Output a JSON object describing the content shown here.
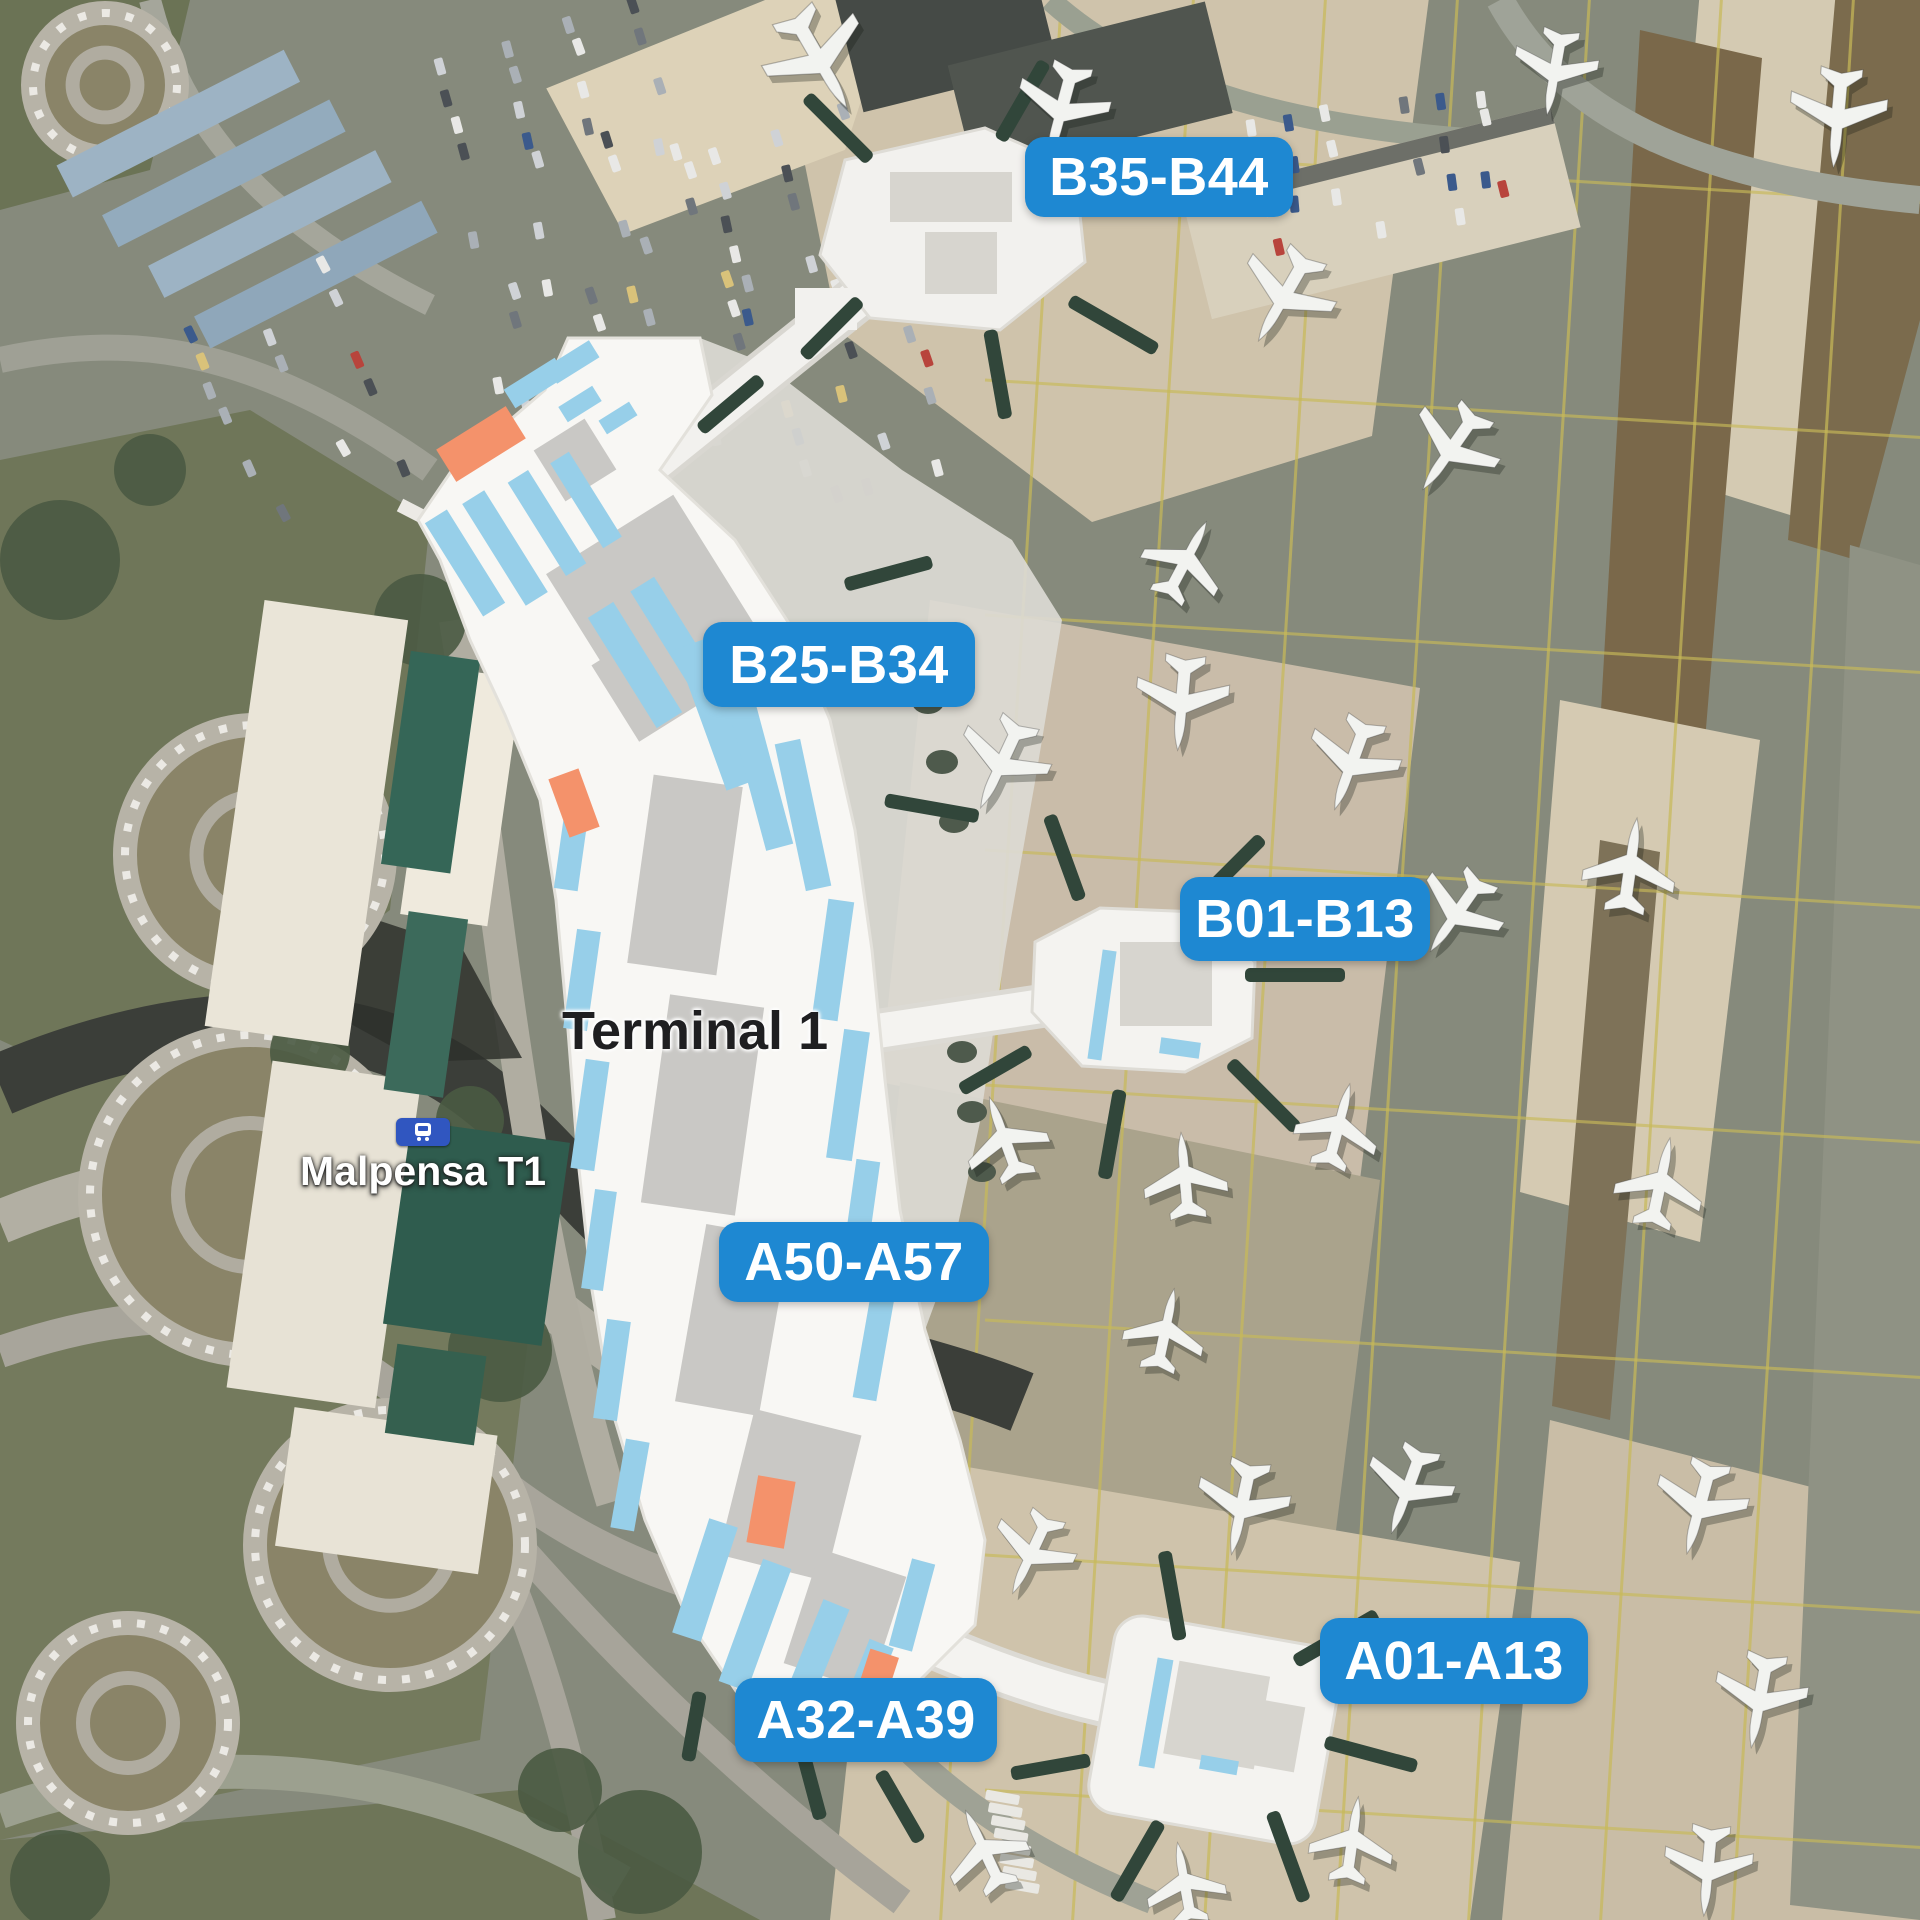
{
  "map": {
    "title": "Terminal 1",
    "station": {
      "label": "Malpensa T1",
      "icon": "transit-train-icon"
    },
    "gate_badges": [
      {
        "id": "B35-B44",
        "label": "B35-B44",
        "x": 1025,
        "y": 137,
        "w": 268,
        "h": 80
      },
      {
        "id": "B25-B34",
        "label": "B25-B34",
        "x": 703,
        "y": 622,
        "w": 272,
        "h": 85
      },
      {
        "id": "B01-B13",
        "label": "B01-B13",
        "x": 1180,
        "y": 877,
        "w": 250,
        "h": 84
      },
      {
        "id": "A50-A57",
        "label": "A50-A57",
        "x": 719,
        "y": 1222,
        "w": 270,
        "h": 80
      },
      {
        "id": "A32-A39",
        "label": "A32-A39",
        "x": 735,
        "y": 1678,
        "w": 262,
        "h": 84
      },
      {
        "id": "A01-A13",
        "label": "A01-A13",
        "x": 1320,
        "y": 1618,
        "w": 268,
        "h": 86
      }
    ],
    "colors": {
      "badge_blue": "#1e88d2",
      "badge_text": "#ffffff",
      "station_icon_blue": "#3056c0",
      "terminal_white": "#f8f7f4",
      "terminal_gray": "#c9c8c5",
      "terminal_blue": "#97cfe9",
      "terminal_orange": "#f4926b",
      "jetbridge_green": "#31463a",
      "apron_tan": "#cfc3ab",
      "tarmac": "#868a7c",
      "taxi_line_yellow": "#c8ba58"
    }
  }
}
